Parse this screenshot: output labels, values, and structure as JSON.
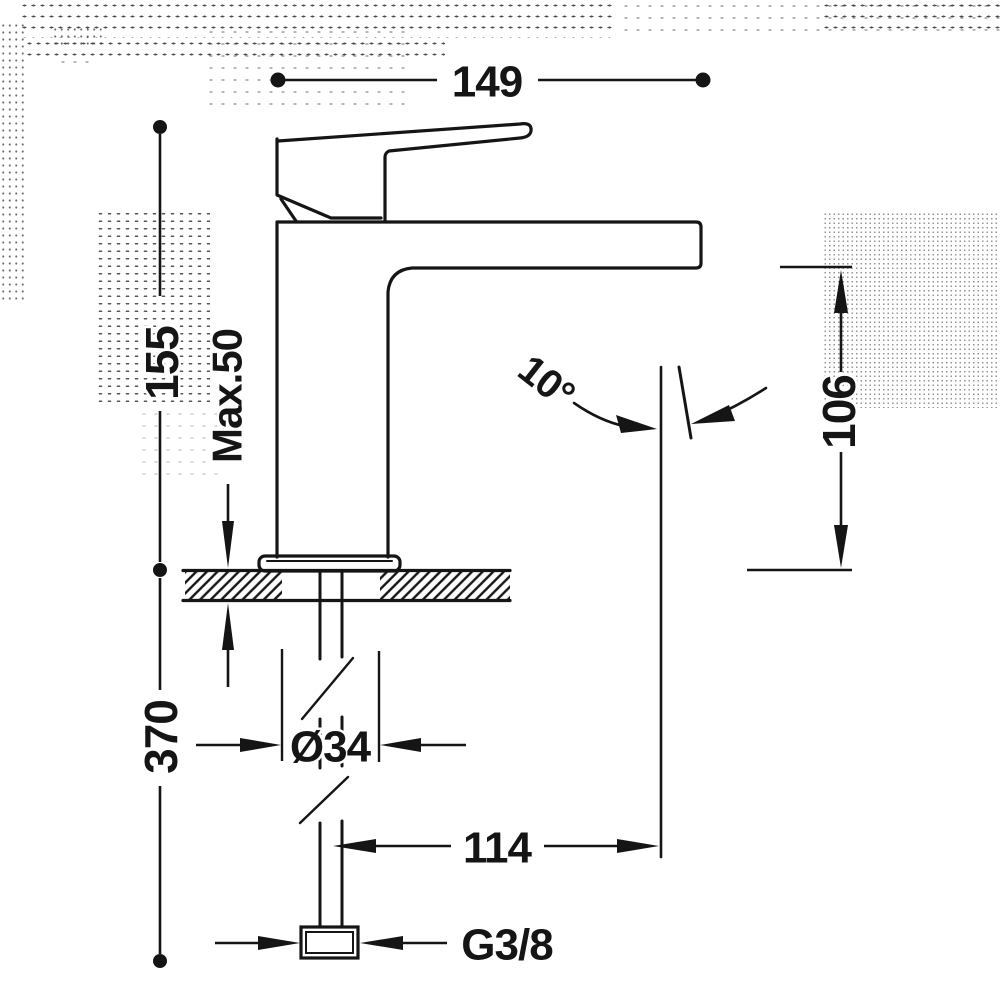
{
  "drawing": {
    "subject": "single-lever basin mixer faucet, side elevation with installation dimensions",
    "units": "mm",
    "line_color": "#151515",
    "background_color": "#ffffff"
  },
  "dimensions": {
    "spout_width": "149",
    "height_above_deck": "155",
    "max_deck_thickness": "Max.50",
    "below_deck_length": "370",
    "hole_diameter": "Ø34",
    "outlet_height": "106",
    "outlet_reach": "114",
    "outlet_angle": "10°",
    "thread_size": "G3/8"
  }
}
